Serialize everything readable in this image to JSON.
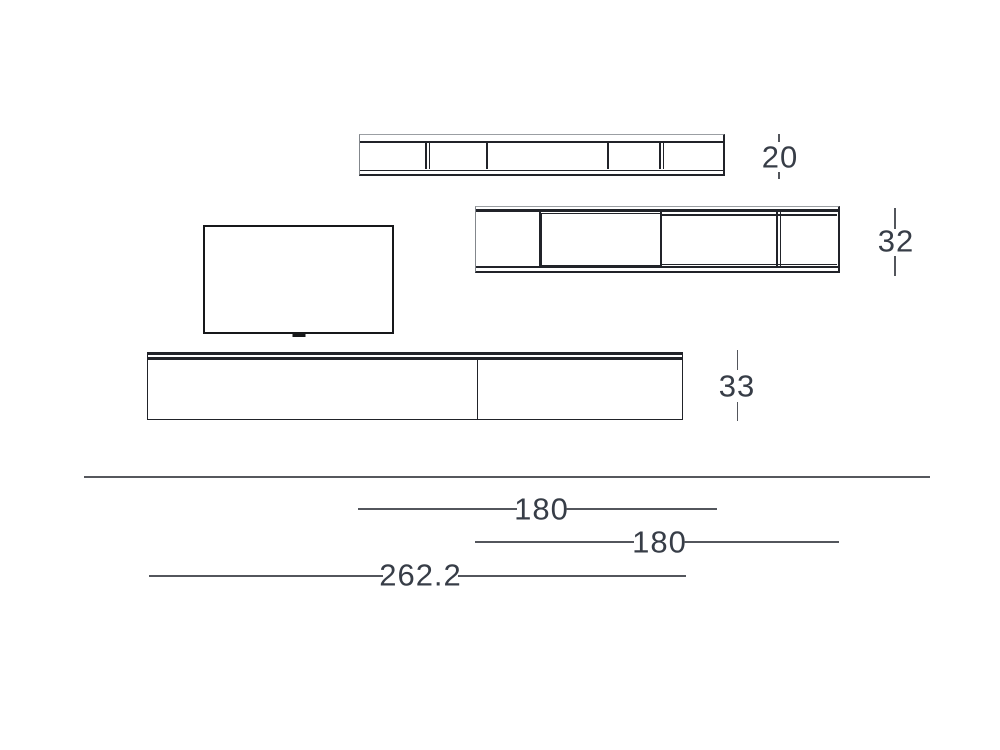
{
  "diagram_title": "wall-unit-technical-drawing",
  "colors": {
    "background": "#ffffff",
    "outline_dark": "#212329",
    "outline_light": "#9b9fa3",
    "dimension_line": "#53565c",
    "label_text": "#373d47"
  },
  "labels": {
    "top_shelf_height": "20",
    "middle_shelf_height": "32",
    "cabinet_height": "33",
    "top_shelf_width": "180",
    "middle_shelf_width": "180",
    "cabinet_width": "262.2"
  },
  "geometry": {
    "units": {
      "top_shelf": {
        "dividers": [
          {
            "x": 65,
            "double": true
          },
          {
            "x": 126,
            "double": false
          },
          {
            "x": 247,
            "double": false
          },
          {
            "x": 299,
            "double": true
          }
        ]
      },
      "middle_shelf": {
        "dividers": [
          {
            "x": 63,
            "double": false
          },
          {
            "x": 184,
            "double": false
          },
          {
            "x": 300,
            "double": true
          }
        ]
      },
      "cabinet": {
        "dividers": [
          {
            "x": 328.5,
            "double": false
          }
        ]
      }
    }
  }
}
